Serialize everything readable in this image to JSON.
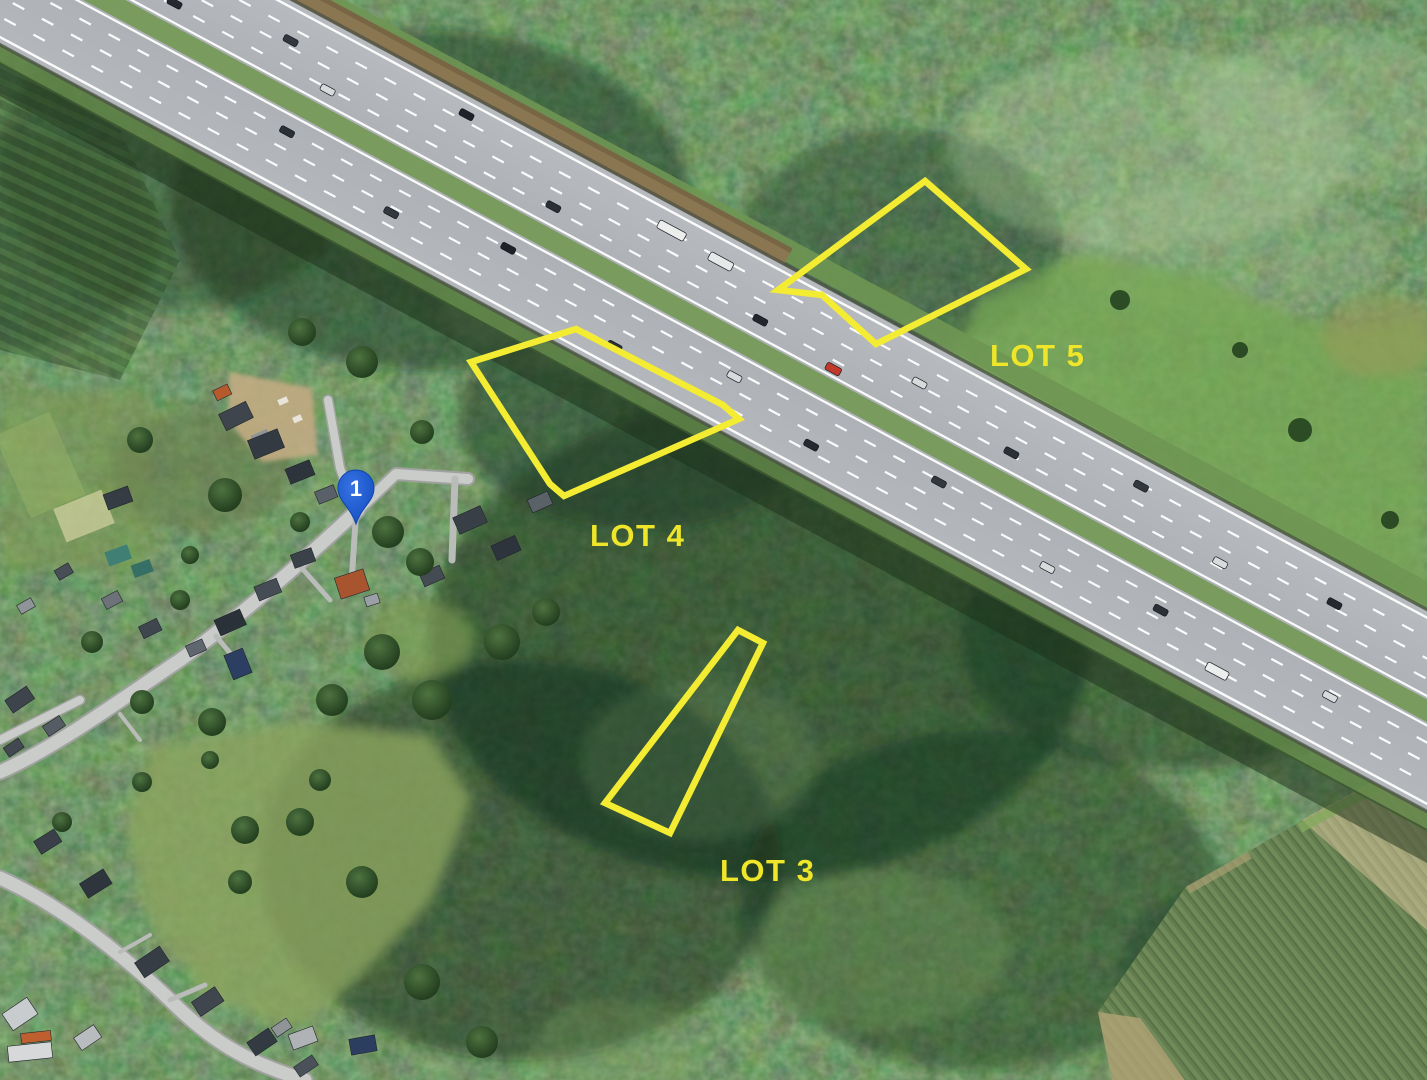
{
  "map": {
    "view": "satellite-aerial",
    "marker": {
      "label": "1"
    },
    "lots": [
      {
        "name": "lot-5",
        "label": "LOT 5",
        "points": "925,181 1026,269 876,344 822,295 778,290",
        "label_x": 990,
        "label_y": 366
      },
      {
        "name": "lot-4",
        "label": "LOT 4",
        "points": "576,329 723,405 739,419 564,496 550,484 471,362",
        "label_x": 590,
        "label_y": 546
      },
      {
        "name": "lot-3",
        "label": "LOT 3",
        "points": "738,630 763,643 670,833 605,803",
        "label_x": 720,
        "label_y": 881
      }
    ],
    "colors": {
      "lot_outline": "#f3ec33",
      "lot_label": "#efe62a",
      "marker_blue": "#1b5ad1",
      "marker_text": "#ffffff"
    }
  }
}
